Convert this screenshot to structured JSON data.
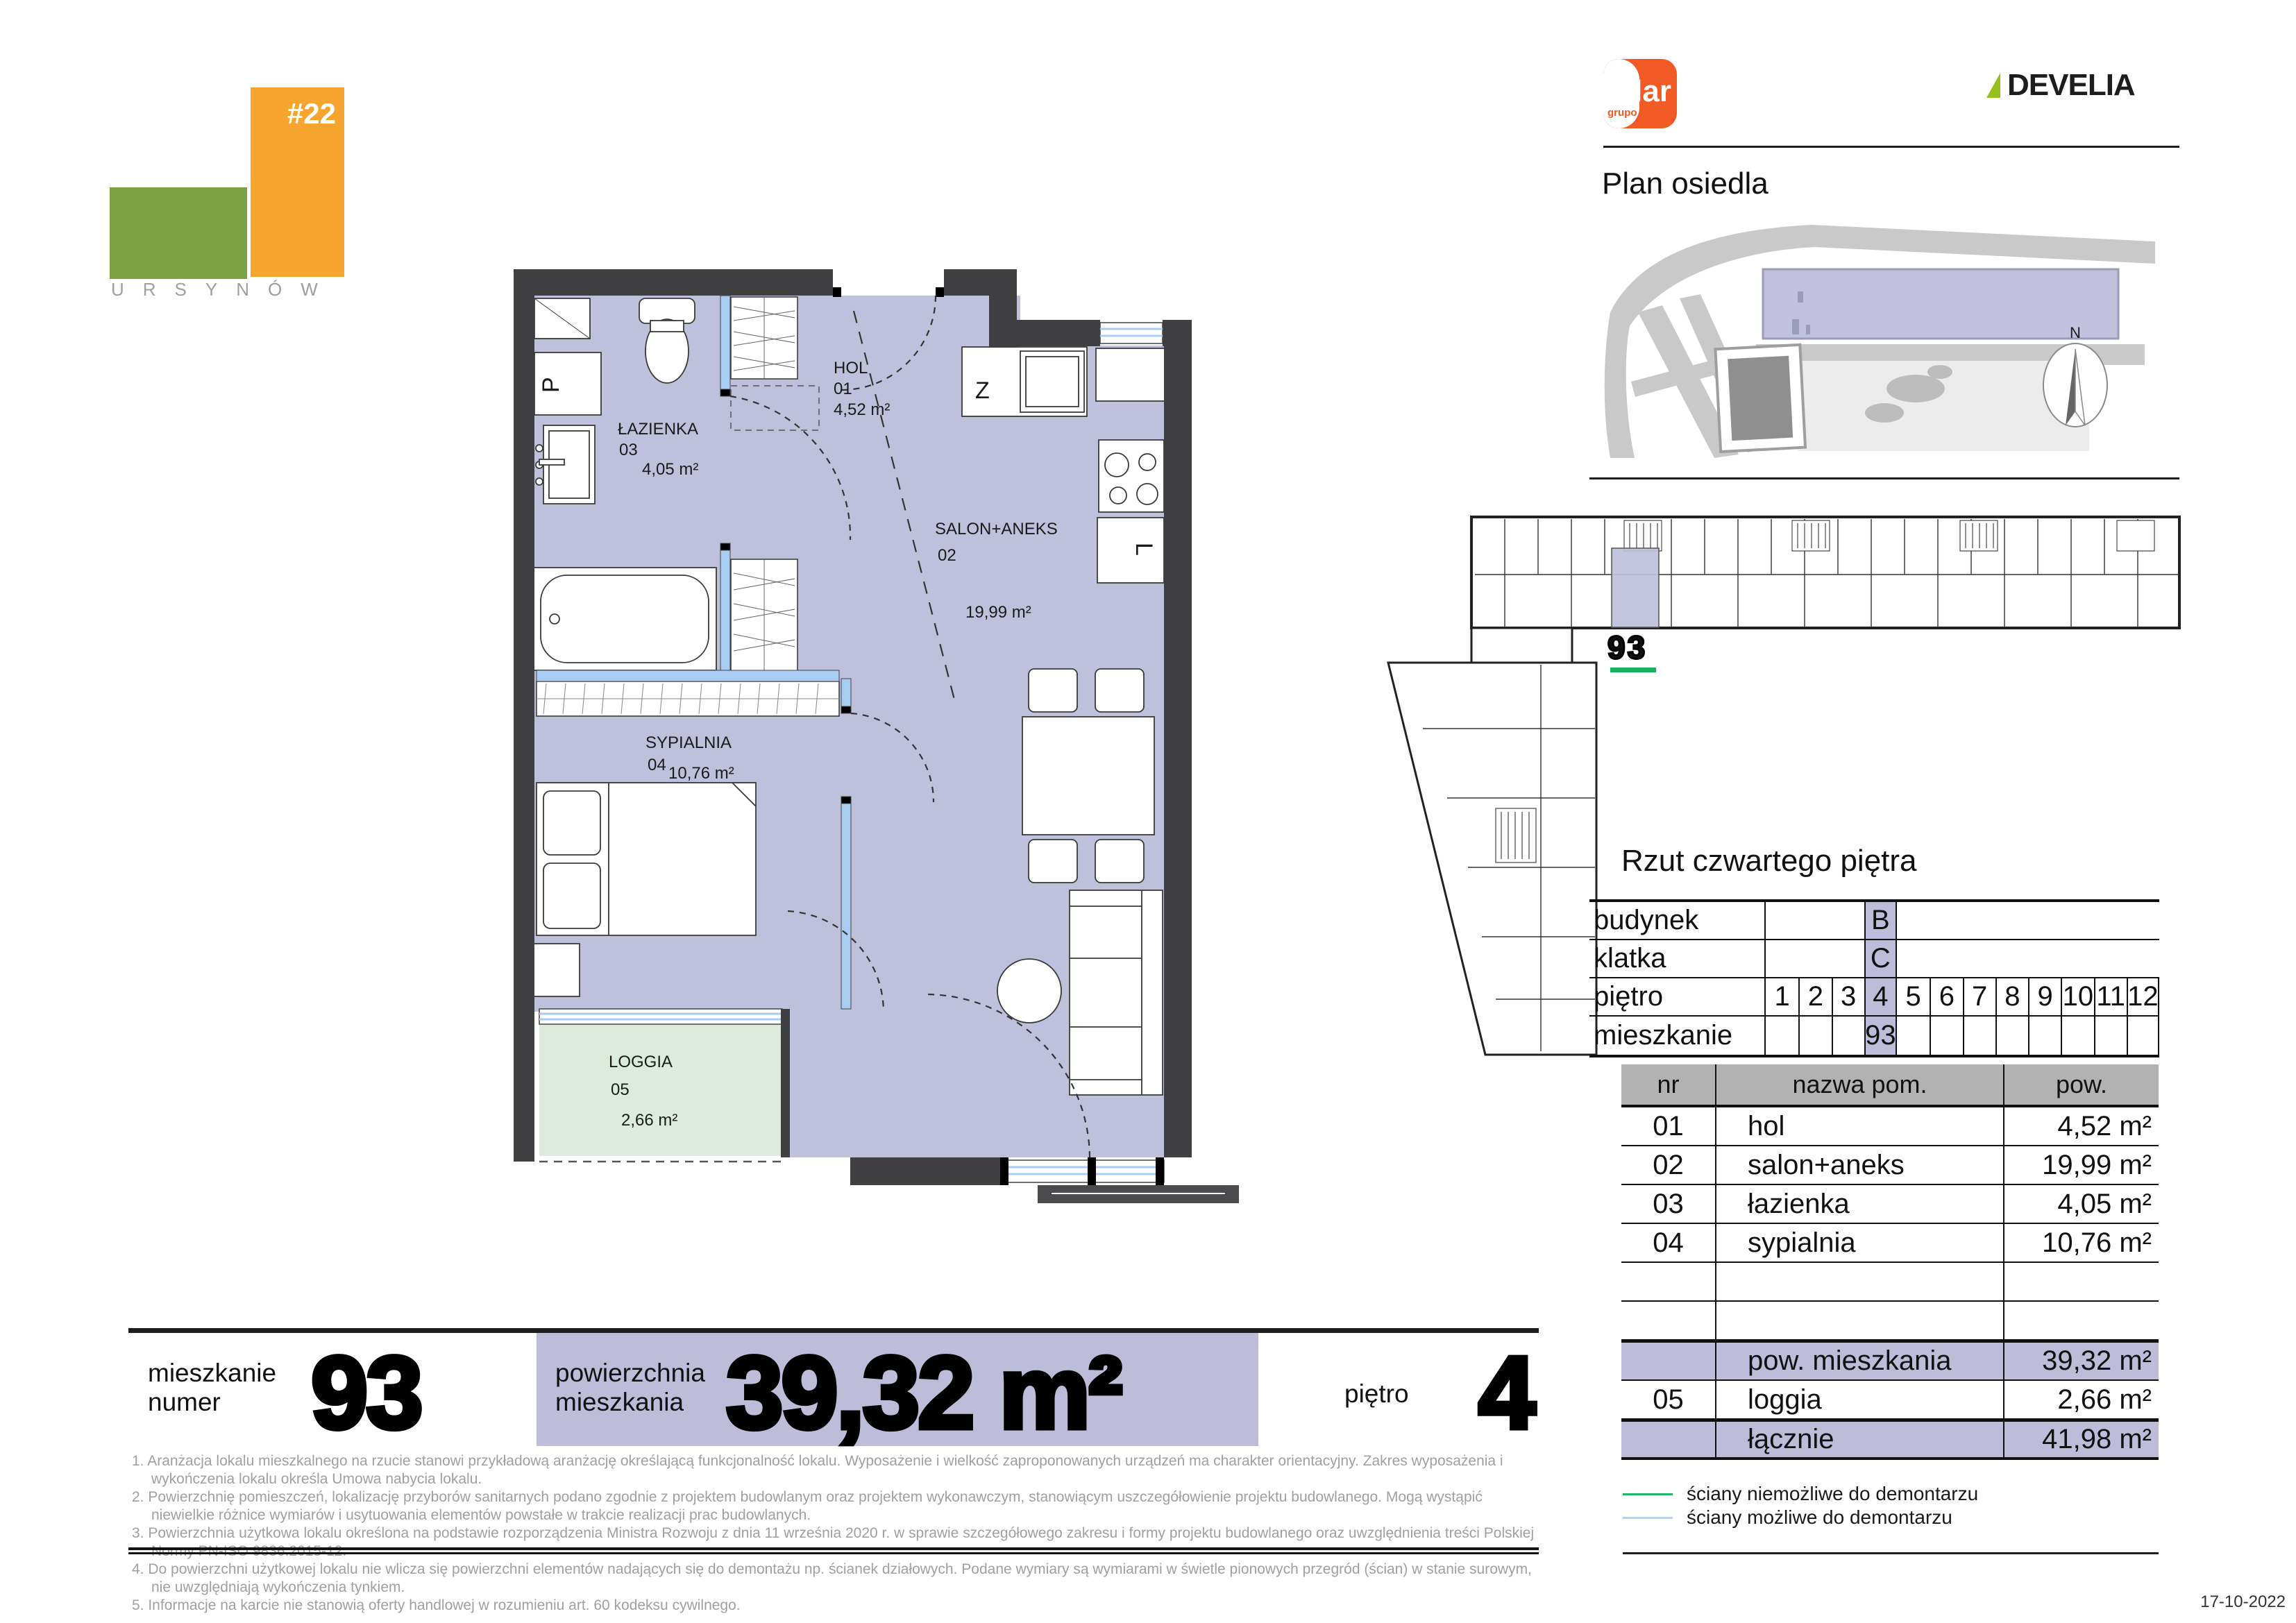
{
  "branding": {
    "project_tag": "#22",
    "district": "URSYNÓW",
    "grupo_label": "grupo",
    "lar_label": "lar",
    "develia_label": "DEVELIA"
  },
  "site_plan": {
    "title": "Plan osiedla",
    "compass_n": "N"
  },
  "building_plan": {
    "unit_number": "93",
    "caption": "Rzut czwartego piętra"
  },
  "apartment_plan": {
    "rooms": {
      "hol": {
        "name": "HOL",
        "nr": "01",
        "area": "4,52 m²"
      },
      "salon": {
        "name": "SALON+ANEKS",
        "nr": "02",
        "area": "19,99 m²"
      },
      "lazienka": {
        "name": "ŁAZIENKA",
        "nr": "03",
        "area": "4,05 m²"
      },
      "sypialnia": {
        "name": "SYPIALNIA",
        "nr": "04",
        "area": "10,76 m²"
      },
      "loggia": {
        "name": "LOGGIA",
        "nr": "05",
        "area": "2,66 m²"
      }
    },
    "markers": {
      "shaft": "P",
      "wardrobe": "Z",
      "sink": "L"
    }
  },
  "info_table": {
    "row_labels": {
      "building": "budynek",
      "staircase": "klatka",
      "floor": "piętro",
      "apartment": "mieszkanie"
    },
    "building_value": "B",
    "staircase_value": "C",
    "floors": [
      "1",
      "2",
      "3",
      "4",
      "5",
      "6",
      "7",
      "8",
      "9",
      "10",
      "11",
      "12"
    ],
    "selected_floor": "4",
    "apartment_value": "93"
  },
  "rooms_table": {
    "headers": {
      "nr": "nr",
      "name": "nazwa pom.",
      "area": "pow."
    },
    "rows": [
      {
        "nr": "01",
        "name": "hol",
        "area": "4,52 m²"
      },
      {
        "nr": "02",
        "name": "salon+aneks",
        "area": "19,99 m²"
      },
      {
        "nr": "03",
        "name": "łazienka",
        "area": "4,05 m²"
      },
      {
        "nr": "04",
        "name": "sypialnia",
        "area": "10,76 m²"
      }
    ],
    "summary": {
      "label": "pow. mieszkania",
      "area": "39,32 m²"
    },
    "loggia_row": {
      "nr": "05",
      "name": "loggia",
      "area": "2,66 m²"
    },
    "total": {
      "label": "łącznie",
      "area": "41,98 m²"
    }
  },
  "footer_bar": {
    "apartment_label_line1": "mieszkanie",
    "apartment_label_line2": "numer",
    "apartment_number": "93",
    "area_label_line1": "powierzchnia",
    "area_label_line2": "mieszkania",
    "area_value": "39,32 m²",
    "floor_label": "piętro",
    "floor_value": "4"
  },
  "footnotes": [
    "1. Aranżacja lokalu mieszkalnego na rzucie stanowi przykładową aranżację określającą funkcjonalność lokalu. Wyposażenie i wielkość zaproponowanych urządzeń ma charakter orientacyjny. Zakres wyposażenia i wykończenia lokalu określa Umowa nabycia lokalu.",
    "2. Powierzchnię pomieszczeń, lokalizację przyborów sanitarnych podano zgodnie z projektem budowlanym oraz projektem wykonawczym, stanowiącym uszczegółowienie projektu budowlanego. Mogą wystąpić niewielkie różnice wymiarów i usytuowania elementów powstałe w trakcie realizacji prac budowlanych.",
    "3. Powierzchnia użytkowa lokalu określona na podstawie rozporządzenia Ministra Rozwoju z dnia 11 września 2020 r. w sprawie szczegółowego zakresu i formy projektu budowlanego oraz uwzględnienia treści Polskiej Normy PN-ISO 9836:2015-12.",
    "4. Do powierzchni użytkowej lokalu nie wlicza się powierzchni elementów nadających się do demontażu np. ścianek działowych. Podane wymiary są wymiarami w świetle pionowych przegród (ścian) w stanie surowym, nie uwzględniają wykończenia tynkiem.",
    "5. Informacje na karcie nie stanowią oferty handlowej w rozumieniu art. 60 kodeksu cywilnego."
  ],
  "legend": {
    "items": [
      {
        "label": "ściany niemożliwe do demontarzu",
        "color": "#1db868"
      },
      {
        "label": "ściany możliwe do demontarzu",
        "color": "#b5d3ec"
      }
    ]
  },
  "date": "17-10-2022",
  "colors": {
    "accent_purple": "#bdbdda",
    "wall": "#3f3f41",
    "room_fill": "#bfc0dc",
    "loggia_fill": "#dcebdd",
    "window_blue": "#a9cdf2",
    "brand_orange": "#f15a24",
    "brand_green": "#95c11f",
    "logo_green": "#7ba346",
    "logo_orange": "#f6a52f",
    "unit_underline_green": "#17b35f"
  }
}
